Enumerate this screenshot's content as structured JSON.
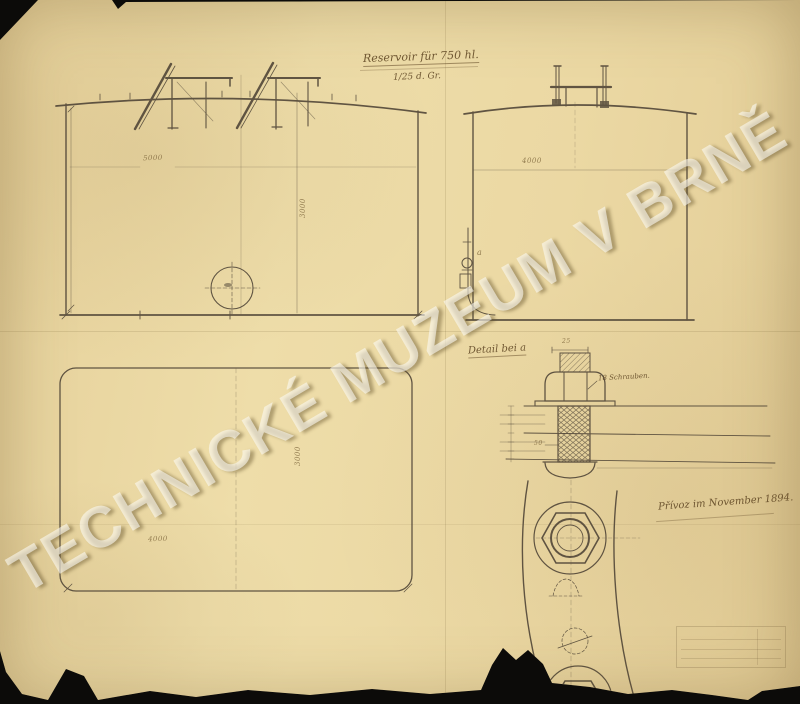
{
  "sheet": {
    "title": "Reservoir für 750 hl.",
    "scale_note": "1/25 d. Gr.",
    "signature": "Přívoz im November 1894.",
    "watermark": "TECHNICKÉ MUZEUM V BRNĚ"
  },
  "side_elevation": {
    "width_dim": "5000",
    "height_dim": "3000"
  },
  "end_elevation": {
    "width_dim": "4000",
    "detail_marker": "a"
  },
  "plan_view": {
    "width_dim": "4000",
    "depth_dim": "3000"
  },
  "bolt_detail": {
    "label": "Detail bei a",
    "screws_note": "18 Schrauben.",
    "dim_top": "25",
    "dim_shank": "50"
  },
  "colors": {
    "paper": "#ecd9a3",
    "ink": "#54493a",
    "background": "#0c0b09",
    "watermark_fill": "#faf6ea"
  }
}
